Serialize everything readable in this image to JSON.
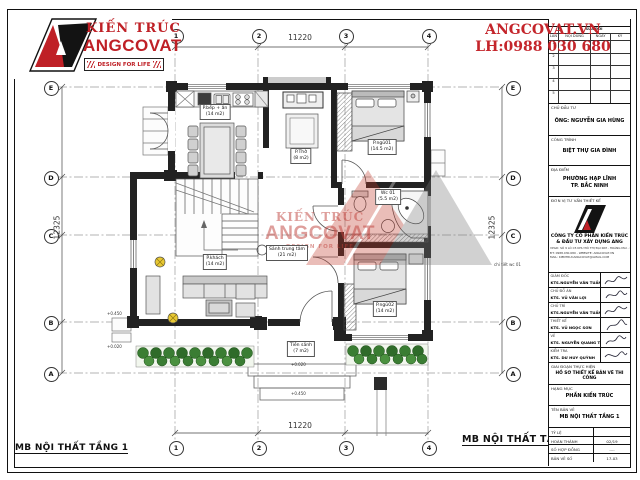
{
  "brand": {
    "logo_line1": "KIẾN TRÚC",
    "logo_line2": "ANGCOVAT",
    "tagline": "DESIGN FOR LIFE",
    "accent_red": "#bf2026"
  },
  "contact": {
    "website": "ANGCOVAT.VN",
    "hotline": "LH:0988 030 680"
  },
  "watermark": {
    "line1": "KIẾN TRÚC",
    "line2": "ANGCOVAT",
    "line3": "DESIGN FOR LIFE"
  },
  "drawing": {
    "title": "MB  NỘI THẤT TẦNG 1",
    "dim_horizontal": "11220",
    "dim_vertical": "12325",
    "grid_cols": [
      "1",
      "2",
      "3",
      "4"
    ],
    "grid_rows": [
      "E",
      "D",
      "C",
      "B",
      "A"
    ],
    "rooms": [
      {
        "name": "P.bếp + ăn",
        "area": "(14 m2)"
      },
      {
        "name": "P.Thờ",
        "area": "(8 m2)"
      },
      {
        "name": "P.ngủ01",
        "area": "(14.5 m2)"
      },
      {
        "name": "Wc 01",
        "area": "(5.5 m2)"
      },
      {
        "name": "Sảnh trung tâm",
        "area": "(21 m2)"
      },
      {
        "name": "P.khách",
        "area": "(14 m2)"
      },
      {
        "name": "P.ngủ02",
        "area": "(14 m2)"
      },
      {
        "name": "Tiền sảnh",
        "area": "(7 m2)"
      }
    ],
    "annotations": {
      "elev_porch": "+0.450",
      "elev_left_top": "+0.450",
      "elev_left_bottom": "+0.020",
      "elev_path": "+0.020",
      "wc_note": "chi tiết wc 01"
    }
  },
  "title_block": {
    "revision": {
      "header": "SỬA ĐỔI",
      "columns": [
        "LẦN",
        "NỘI DUNG",
        "NGÀY",
        "KÝ"
      ],
      "rows": [
        "1",
        "2",
        "3",
        "4",
        "5"
      ]
    },
    "investor": {
      "label": "CHỦ ĐẦU TƯ",
      "value": "ÔNG:  NGUYỄN GIA HÙNG"
    },
    "project": {
      "label": "CÔNG TRÌNH",
      "value": "BIỆT THỰ GIA ĐÌNH"
    },
    "location": {
      "label": "ĐỊA ĐIỂM",
      "line1": "PHƯỜNG HẠP LĨNH",
      "line2": "TP. BẮC NINH"
    },
    "design_unit": {
      "label": "ĐƠN VỊ TƯ VẤN THIẾT KẾ",
      "company_line1": "CÔNG TY CỔ PHẦN KIẾN TRÚC",
      "company_line2": "& ĐẦU TƯ XÂY DỰNG  ANG",
      "address_line1": "VPGD: SỐ 9 LÔ C5 KHU ĐÔ THỊ ĐẠI KIM - HOÀNG MAI - HN",
      "address_line2": "ĐT: 0988.030.680 - WEBSITE: ANGCOVAT.VN",
      "address_line3": "MAIL: KIENTRUCANGCOVAT@GMAIL.COM"
    },
    "signatures": [
      {
        "role": "GIÁM ĐỐC",
        "name": "KTS.NGUYỄN VĂN TUẤN"
      },
      {
        "role": "CHỦ ĐỒ ÁN",
        "name": "KTS. VŨ VĂN LỢI"
      },
      {
        "role": "CHỦ TRÌ",
        "name": "KTS.NGUYỄN VĂN TUẤN"
      },
      {
        "role": "THIẾT KẾ",
        "name": "KTS. VŨ NGỌC SƠN"
      },
      {
        "role": "VẼ",
        "name": "KTS. NGUYỄN QUANG THÁI"
      },
      {
        "role": "KIỂM TRA",
        "name": "KTS. DƯ HUY QUỲNH"
      }
    ],
    "stage": {
      "label": "GIAI ĐOẠN THỰC HIỆN",
      "value": "HỒ SƠ THIẾT KẾ BẢN VẼ THI CÔNG"
    },
    "category": {
      "label": "HẠNG MỤC",
      "value": "PHẦN KIẾN TRÚC"
    },
    "sheet": {
      "label": "TÊN BẢN VẼ",
      "value": "MB NỘI THẤT TẦNG 1"
    },
    "meta": [
      {
        "label": "TỶ LỆ",
        "value": ""
      },
      {
        "label": "HOÀN THÀNH",
        "value": "02/19"
      },
      {
        "label": "SỐ HỢP ĐỒNG",
        "value": "-..-"
      },
      {
        "label": "BẢN VẼ SỐ",
        "value": "17-03"
      }
    ]
  }
}
